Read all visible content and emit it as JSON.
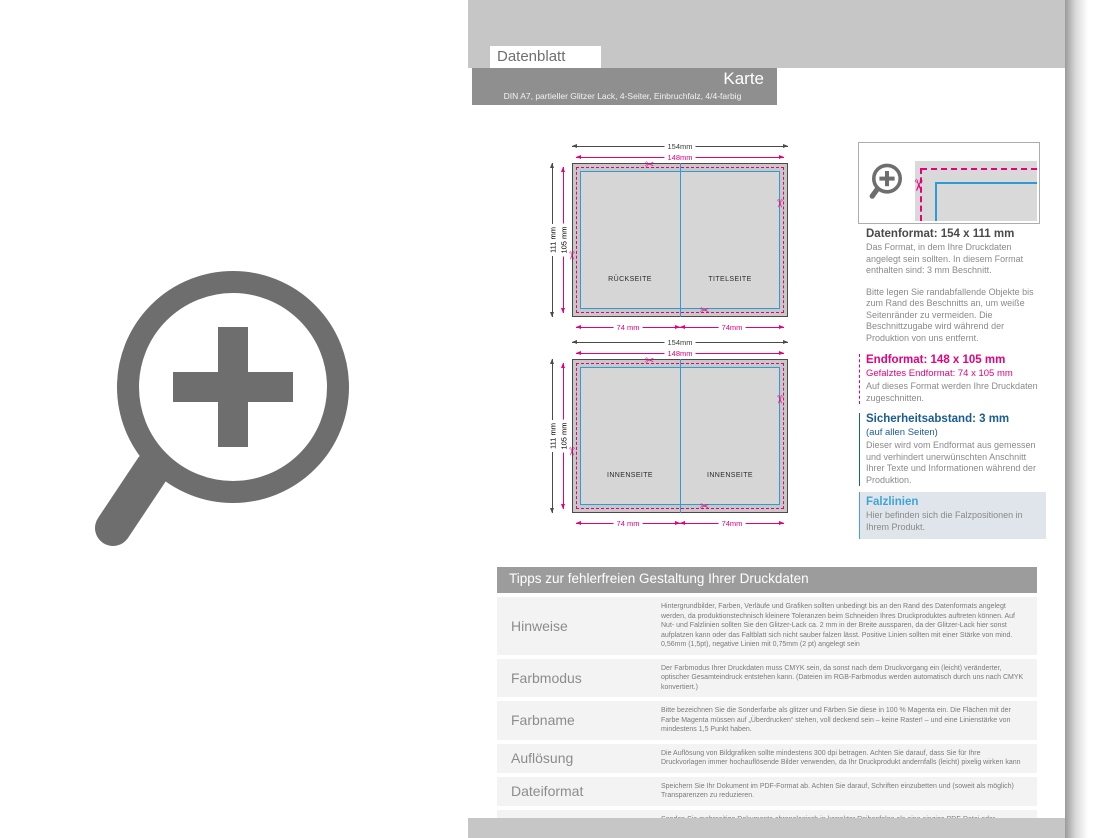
{
  "header": {
    "tab": "Datenblatt",
    "title": "Karte",
    "subtitle": "DIN A7, partieller Glitzer Lack, 4-Seiter, Einbruchfalz, 4/4-farbig"
  },
  "icons": {
    "scissors": "✂"
  },
  "diagrams": {
    "top": {
      "dim_width": "154mm",
      "dim_trim_width": "148mm",
      "dim_height": "111 mm",
      "dim_trim_height": "105 mm",
      "dim_fold_left": "74 mm",
      "dim_fold_right": "74mm",
      "label_left": "RÜCKSEITE",
      "label_right": "TITELSEITE"
    },
    "bottom": {
      "dim_width": "154mm",
      "dim_trim_width": "148mm",
      "dim_height": "111 mm",
      "dim_trim_height": "105 mm",
      "dim_fold_left": "74 mm",
      "dim_fold_right": "74mm",
      "label_left": "INNENSEITE",
      "label_right": "INNENSEITE"
    }
  },
  "info_panel": {
    "datenformat": {
      "title": "Datenformat: 154 x 111 mm",
      "p1": "Das Format, in dem Ihre Druckdaten angelegt sein sollten. In diesem Format enthalten sind: 3 mm Beschnitt.",
      "p2": "Bitte legen Sie randabfallende Objekte bis zum Rand des Beschnitts an, um weiße Seitenränder zu vermeiden. Die Beschnittzugabe wird während der Produktion von uns entfernt."
    },
    "endformat": {
      "title": "Endformat: 148 x 105 mm",
      "subtitle": "Gefalztes Endformat: 74 x 105 mm",
      "body": "Auf dieses Format werden Ihre Druckdaten zugeschnitten."
    },
    "sicherheitsabstand": {
      "title": "Sicherheitsabstand: 3 mm",
      "subtitle": "(auf allen Seiten)",
      "body": "Dieser wird vom Endformat aus gemessen und verhindert unerwünschten Anschnitt Ihrer Texte und Informationen während der Produktion."
    },
    "falzlinien": {
      "title": "Falzlinien",
      "body": "Hier befinden sich die Falzpositionen in Ihrem Produkt."
    }
  },
  "tips_table": {
    "title": "Tipps zur fehlerfreien Gestaltung Ihrer Druckdaten",
    "rows": [
      {
        "label": "Hinweise",
        "text": "Hintergrundbilder, Farben, Verläufe und Grafiken sollten unbedingt bis an den Rand des Datenformats angelegt werden, da produktionstechnisch kleinere Toleranzen beim Schneiden Ihres Druckproduktes auftreten können. Auf Nut- und Falzlinien sollten Sie den Glitzer-Lack ca. 2 mm in der Breite aussparen, da der Glitzer-Lack hier sonst aufplatzen kann oder das Faltblatt sich nicht sauber falzen lässt. Positive Linien sollten mit einer Stärke von mind. 0,56mm (1,5pt), negative Linien mit 0,75mm (2 pt) angelegt sein"
      },
      {
        "label": "Farbmodus",
        "text": "Der Farbmodus Ihrer Druckdaten muss CMYK sein, da sonst nach dem Druckvorgang ein (leicht) veränderter, optischer Gesamteindruck entstehen kann. (Dateien im RGB-Farbmodus werden automatisch durch uns nach CMYK konvertiert.)"
      },
      {
        "label": "Farbname",
        "text": "Bitte bezeichnen Sie die Sonderfarbe als glitzer und Färben Sie diese in 100 % Magenta ein. Die Flächen mit der Farbe Magenta müssen auf „Überdrucken“ stehen, voll deckend sein – keine Raster! – und eine Linienstärke von mindestens 1,5 Punkt haben."
      },
      {
        "label": "Auflösung",
        "text": "Die Auflösung von Bildgrafiken sollte mindestens 300 dpi betragen. Achten Sie darauf, dass Sie für Ihre Druckvorlagen immer hochauflösende Bilder verwenden, da Ihr Druckprodukt andernfalls (leicht) pixelig wirken kann"
      },
      {
        "label": "Dateiformat",
        "text": "Speichern Sie Ihr Dokument im PDF-Format ab. Achten Sie darauf, Schriften einzubetten und (soweit als möglich) Transparenzen zu reduzieren."
      },
      {
        "label": "Seiten(-reihenfolge)",
        "text": "Senden Sie mehrseitige Dokumente chronologisch in korrekter Reihenfolge als eine einzige PDF-Datei oder benennen Sie Einzeldokumente entsprechend mit fortlaufenden Seitennummern."
      }
    ]
  },
  "colors": {
    "accent_magenta": "#e6007e",
    "accent_blue": "#2e9bd6",
    "accent_darkblue": "#1a5c94",
    "accent_cyan": "#3fa5d8",
    "bar_gray": "#8f8f8f",
    "strip_gray": "#c6c6c6"
  }
}
